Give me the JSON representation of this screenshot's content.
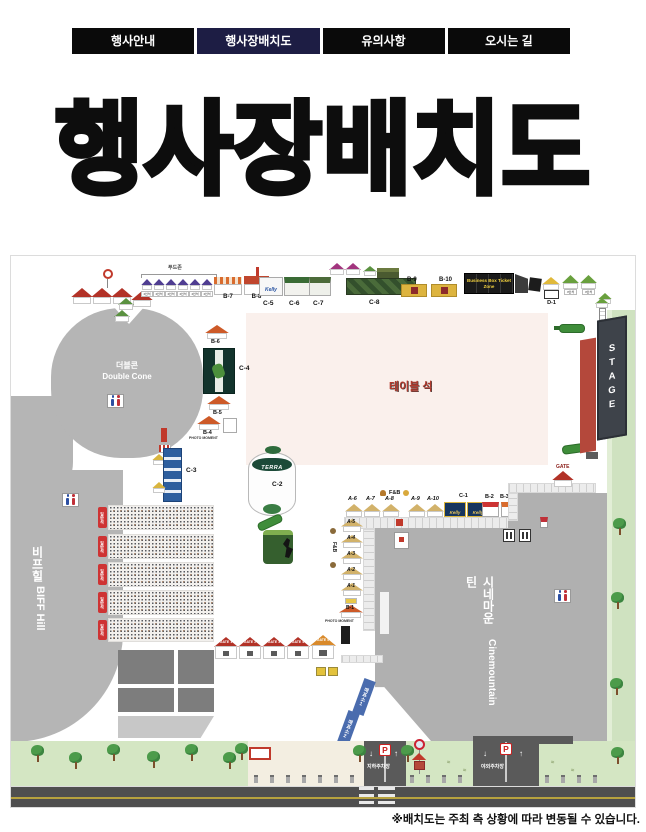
{
  "nav": {
    "tabs": [
      "행사안내",
      "행사장배치도",
      "유의사항",
      "오시는 길"
    ]
  },
  "title": {
    "text": "행사장배치도"
  },
  "map": {
    "zones": {
      "double_cone_ko": "더블콘",
      "double_cone_en": "Double Cone",
      "biff_ko": "비프힐",
      "biff_en": "BIFF Hill",
      "cinema_ko": "시네마운틴",
      "cinema_en": "Cinemountain",
      "stage": "STAGE",
      "table_seats": "테이블 석",
      "business_box": "Business Box Ticket Zone",
      "food_zone": "푸드존",
      "seat_chip": "4인석",
      "seat_tag": "일반석",
      "fnb": "F&B",
      "photo": "PHOTO MOMENT",
      "gate": "GATE",
      "terra": "TERRA",
      "kelly": "Kelly"
    },
    "booths": {
      "a1": "A-1",
      "a2": "A-2",
      "a3": "A-3",
      "a4": "A-4",
      "a5": "A-5",
      "a6": "A-6",
      "a7": "A-7",
      "a8": "A-8",
      "a9": "A-9",
      "a10": "A-10",
      "b1": "B-1",
      "b2": "B-2",
      "b3": "B-3",
      "b4": "B-4",
      "b5": "B-5",
      "b6": "B-6",
      "b7": "B-7",
      "b8": "B-8",
      "b9": "B-9",
      "b10": "B-10",
      "c1": "C-1",
      "c2": "C-2",
      "c3": "C-3",
      "c4": "C-4",
      "c5": "C-5",
      "c6": "C-6",
      "c7": "C-7",
      "c8": "C-8",
      "d1": "D-1"
    },
    "gates": {
      "g1": "GATE 1",
      "g2": "GATE 2",
      "g3": "GATE 3",
      "g4": "GATE 4",
      "g5": "GATE 5"
    },
    "tickets": {
      "t1": "매표소1",
      "t2": "매표소2"
    },
    "parking": {
      "p": "P",
      "underground": "지하주차장",
      "outdoor": "야외주차장"
    }
  },
  "footer": {
    "note": "※배치도는 주최 측 상황에 따라 변동될 수 있습니다."
  }
}
